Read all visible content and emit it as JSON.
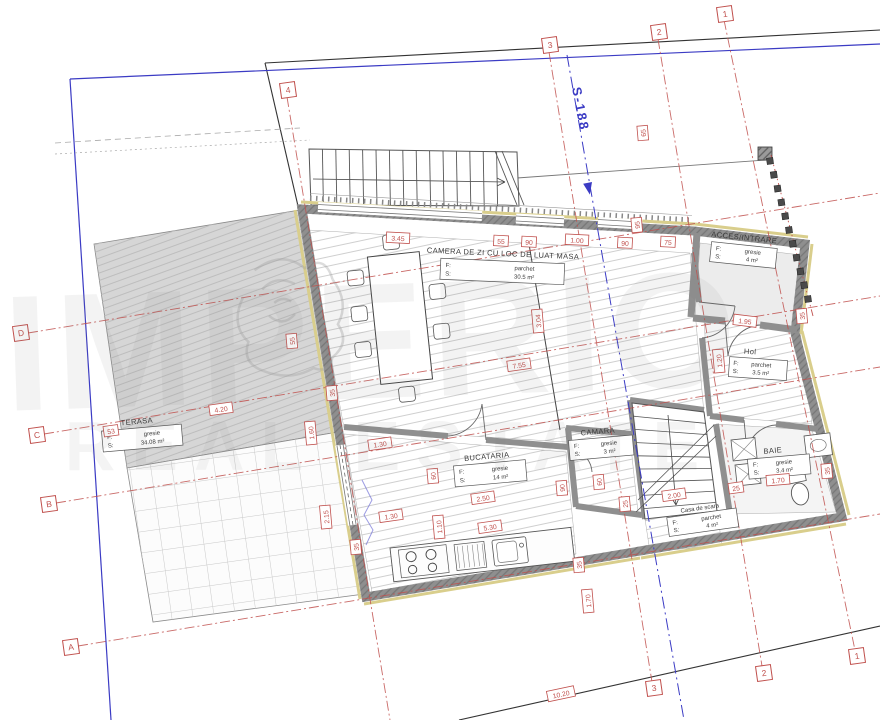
{
  "watermark": {
    "brand": "IMPERIO",
    "tagline": "REAL ESTATE"
  },
  "survey_marker": {
    "label": "S-188"
  },
  "colors": {
    "grid_red": "#c0504d",
    "boundary_blue": "#3b3bc4",
    "wall_gray": "#8f8f8f",
    "insulation_yellow": "#d9ce8c"
  },
  "rooms": [
    {
      "name": "CAMERA DE ZI CU LOC DE LUAT MASA",
      "f_label": "F:",
      "floor": "parchet",
      "s_label": "S:",
      "area": "30.5 m²"
    },
    {
      "name": "TERASA",
      "f_label": "F:",
      "floor": "gresie",
      "s_label": "S:",
      "area": "34.08 m²"
    },
    {
      "name": "BUCATARIA",
      "f_label": "F:",
      "floor": "gresie",
      "s_label": "S:",
      "area": "14 m²"
    },
    {
      "name": "CAMARA",
      "f_label": "F:",
      "floor": "gresie",
      "s_label": "S:",
      "area": "3 m²"
    },
    {
      "name": "Casa de scara",
      "f_label": "F:",
      "floor": "parchet",
      "s_label": "S:",
      "area": "4 m²"
    },
    {
      "name": "Hol",
      "f_label": "F:",
      "floor": "parchet",
      "s_label": "S:",
      "area": "3.5 m²"
    },
    {
      "name": "BAIE",
      "f_label": "F:",
      "floor": "gresie",
      "s_label": "S:",
      "area": "3.4 m²"
    },
    {
      "name": "ACCES/INTRARE",
      "f_label": "F:",
      "floor": "gresie",
      "s_label": "S:",
      "area": "4 m²"
    }
  ],
  "grid_axes": {
    "vertical_labels": [
      "1",
      "2",
      "3",
      "4"
    ],
    "horizontal_labels": [
      "A",
      "B",
      "C",
      "D"
    ],
    "bubbles": [
      {
        "t": "4",
        "x": 288,
        "y": 90
      },
      {
        "t": "3",
        "x": 550,
        "y": 45
      },
      {
        "t": "2",
        "x": 659,
        "y": 32
      },
      {
        "t": "1",
        "x": 725,
        "y": 14
      },
      {
        "t": "3",
        "x": 654,
        "y": 688
      },
      {
        "t": "2",
        "x": 764,
        "y": 673
      },
      {
        "t": "1",
        "x": 857,
        "y": 656
      },
      {
        "t": "D",
        "x": 21,
        "y": 333
      },
      {
        "t": "C",
        "x": 37,
        "y": 435
      },
      {
        "t": "B",
        "x": 49,
        "y": 504
      },
      {
        "t": "A",
        "x": 71,
        "y": 647
      }
    ]
  },
  "dimensions": [
    {
      "t": "3.45",
      "x": 398,
      "y": 238,
      "r": 3
    },
    {
      "t": "55",
      "x": 501,
      "y": 241,
      "r": 3
    },
    {
      "t": "90",
      "x": 529,
      "y": 242,
      "r": 3
    },
    {
      "t": "1.00",
      "x": 577,
      "y": 240,
      "r": 3
    },
    {
      "t": "90",
      "x": 625,
      "y": 243,
      "r": 3
    },
    {
      "t": "75",
      "x": 668,
      "y": 242,
      "r": 3
    },
    {
      "t": "95",
      "x": 637,
      "y": 225,
      "r": -95
    },
    {
      "t": "65",
      "x": 643,
      "y": 133,
      "r": -95
    },
    {
      "t": "1.95",
      "x": 745,
      "y": 321,
      "r": 7
    },
    {
      "t": "35",
      "x": 802,
      "y": 316,
      "r": -95
    },
    {
      "t": "1.20",
      "x": 719,
      "y": 361,
      "r": -95
    },
    {
      "t": "35",
      "x": 827,
      "y": 471,
      "r": -95
    },
    {
      "t": "1.70",
      "x": 778,
      "y": 480,
      "r": -5
    },
    {
      "t": "25",
      "x": 736,
      "y": 488,
      "r": -8
    },
    {
      "t": "2.00",
      "x": 674,
      "y": 495,
      "r": -8
    },
    {
      "t": "25",
      "x": 625,
      "y": 504,
      "r": -95
    },
    {
      "t": "2.50",
      "x": 483,
      "y": 498,
      "r": -8
    },
    {
      "t": "5.30",
      "x": 490,
      "y": 527,
      "r": -8
    },
    {
      "t": "1.10",
      "x": 439,
      "y": 527,
      "r": -95
    },
    {
      "t": "1.30",
      "x": 380,
      "y": 444,
      "r": -8
    },
    {
      "t": "1.30",
      "x": 391,
      "y": 516,
      "r": -8
    },
    {
      "t": "60",
      "x": 433,
      "y": 476,
      "r": -95
    },
    {
      "t": "1.60",
      "x": 311,
      "y": 433,
      "r": -95
    },
    {
      "t": "2.15",
      "x": 326,
      "y": 517,
      "r": -95
    },
    {
      "t": "35",
      "x": 356,
      "y": 547,
      "r": -95
    },
    {
      "t": "4.20",
      "x": 221,
      "y": 409,
      "r": -8
    },
    {
      "t": "53",
      "x": 111,
      "y": 431,
      "r": -8
    },
    {
      "t": "3.04",
      "x": 538,
      "y": 321,
      "r": -95
    },
    {
      "t": "7.55",
      "x": 519,
      "y": 365,
      "r": -8
    },
    {
      "t": "90",
      "x": 562,
      "y": 488,
      "r": -95
    },
    {
      "t": "60",
      "x": 599,
      "y": 482,
      "r": -95
    },
    {
      "t": "1.70",
      "x": 588,
      "y": 601,
      "r": -95
    },
    {
      "t": "35",
      "x": 579,
      "y": 565,
      "r": -95
    },
    {
      "t": "55",
      "x": 292,
      "y": 341,
      "r": -95
    },
    {
      "t": "35",
      "x": 332,
      "y": 393,
      "r": -95
    },
    {
      "t": "10.20",
      "x": 561,
      "y": 694,
      "r": -12
    }
  ]
}
